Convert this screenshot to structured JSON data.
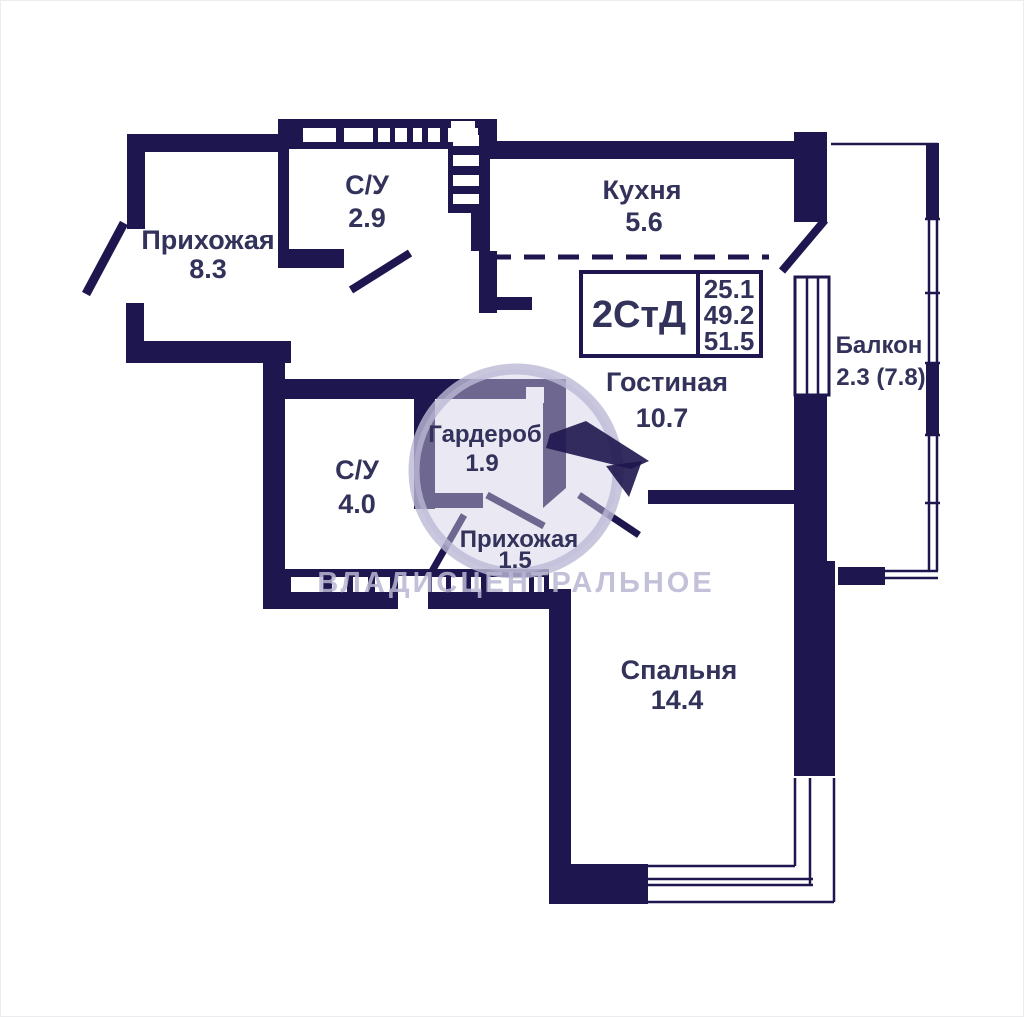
{
  "plan": {
    "title": "Floor plan 2-room studio apartment",
    "unit_info": {
      "type_label": "2СтД",
      "areas": [
        "25.1",
        "49.2",
        "51.5"
      ]
    },
    "watermark": "ВЛАДИСЦЕНТРАЛЬНОЕ",
    "rooms": [
      {
        "id": "hallway-main",
        "name": "Прихожая",
        "area": "8.3"
      },
      {
        "id": "bathroom-top",
        "name": "С/У",
        "area": "2.9"
      },
      {
        "id": "kitchen",
        "name": "Кухня",
        "area": "5.6"
      },
      {
        "id": "balcony",
        "name": "Балкон",
        "area": "2.3 (7.8)"
      },
      {
        "id": "living-room",
        "name": "Гостиная",
        "area": "10.7"
      },
      {
        "id": "bathroom-main",
        "name": "С/У",
        "area": "4.0"
      },
      {
        "id": "wardrobe",
        "name": "Гардероб",
        "area": "1.9"
      },
      {
        "id": "hallway-inner",
        "name": "Прихожая",
        "area": "1.5"
      },
      {
        "id": "bedroom",
        "name": "Спальня",
        "area": "14.4"
      }
    ],
    "colors": {
      "wall": "#1e164e",
      "label": "#32325a",
      "watermark": "#b9b6d2",
      "background": "#ffffff"
    }
  }
}
